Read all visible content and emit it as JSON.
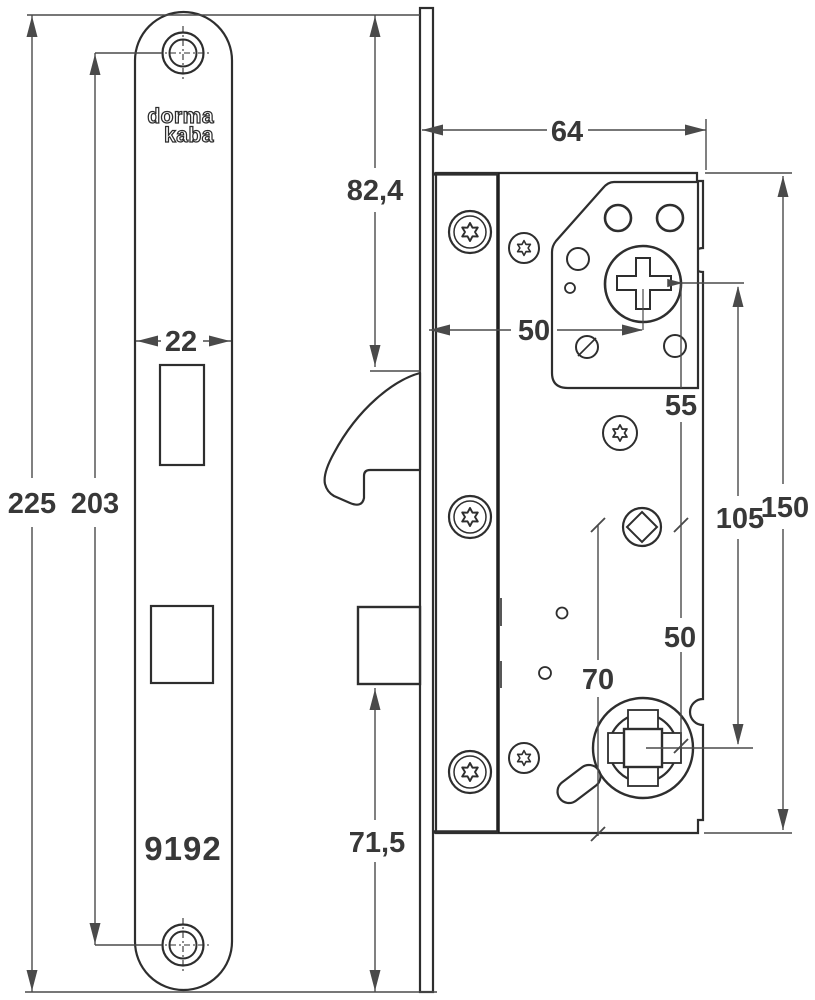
{
  "drawing": {
    "type": "mortise-lock technical dimension drawing",
    "faceplate": {
      "brand_line1": "dorma",
      "brand_line2": "kaba",
      "model": "9192"
    },
    "dimensions": {
      "faceplate_total_height": "225",
      "screw_center_distance": "203",
      "faceplate_width": "22",
      "latch_top_offset": "82,4",
      "bolt_bottom_offset": "71,5",
      "case_depth": "64",
      "backset": "50",
      "cylinder_to_aux_spindle": "55",
      "aux_to_follower": "50",
      "cylinder_to_follower": "105",
      "case_height": "150",
      "aux_to_case_bottom": "70"
    },
    "colors": {
      "object_line": "#2e2e2e",
      "dimension_line": "#4a4a4a",
      "text": "#383838",
      "background": "#ffffff"
    }
  }
}
